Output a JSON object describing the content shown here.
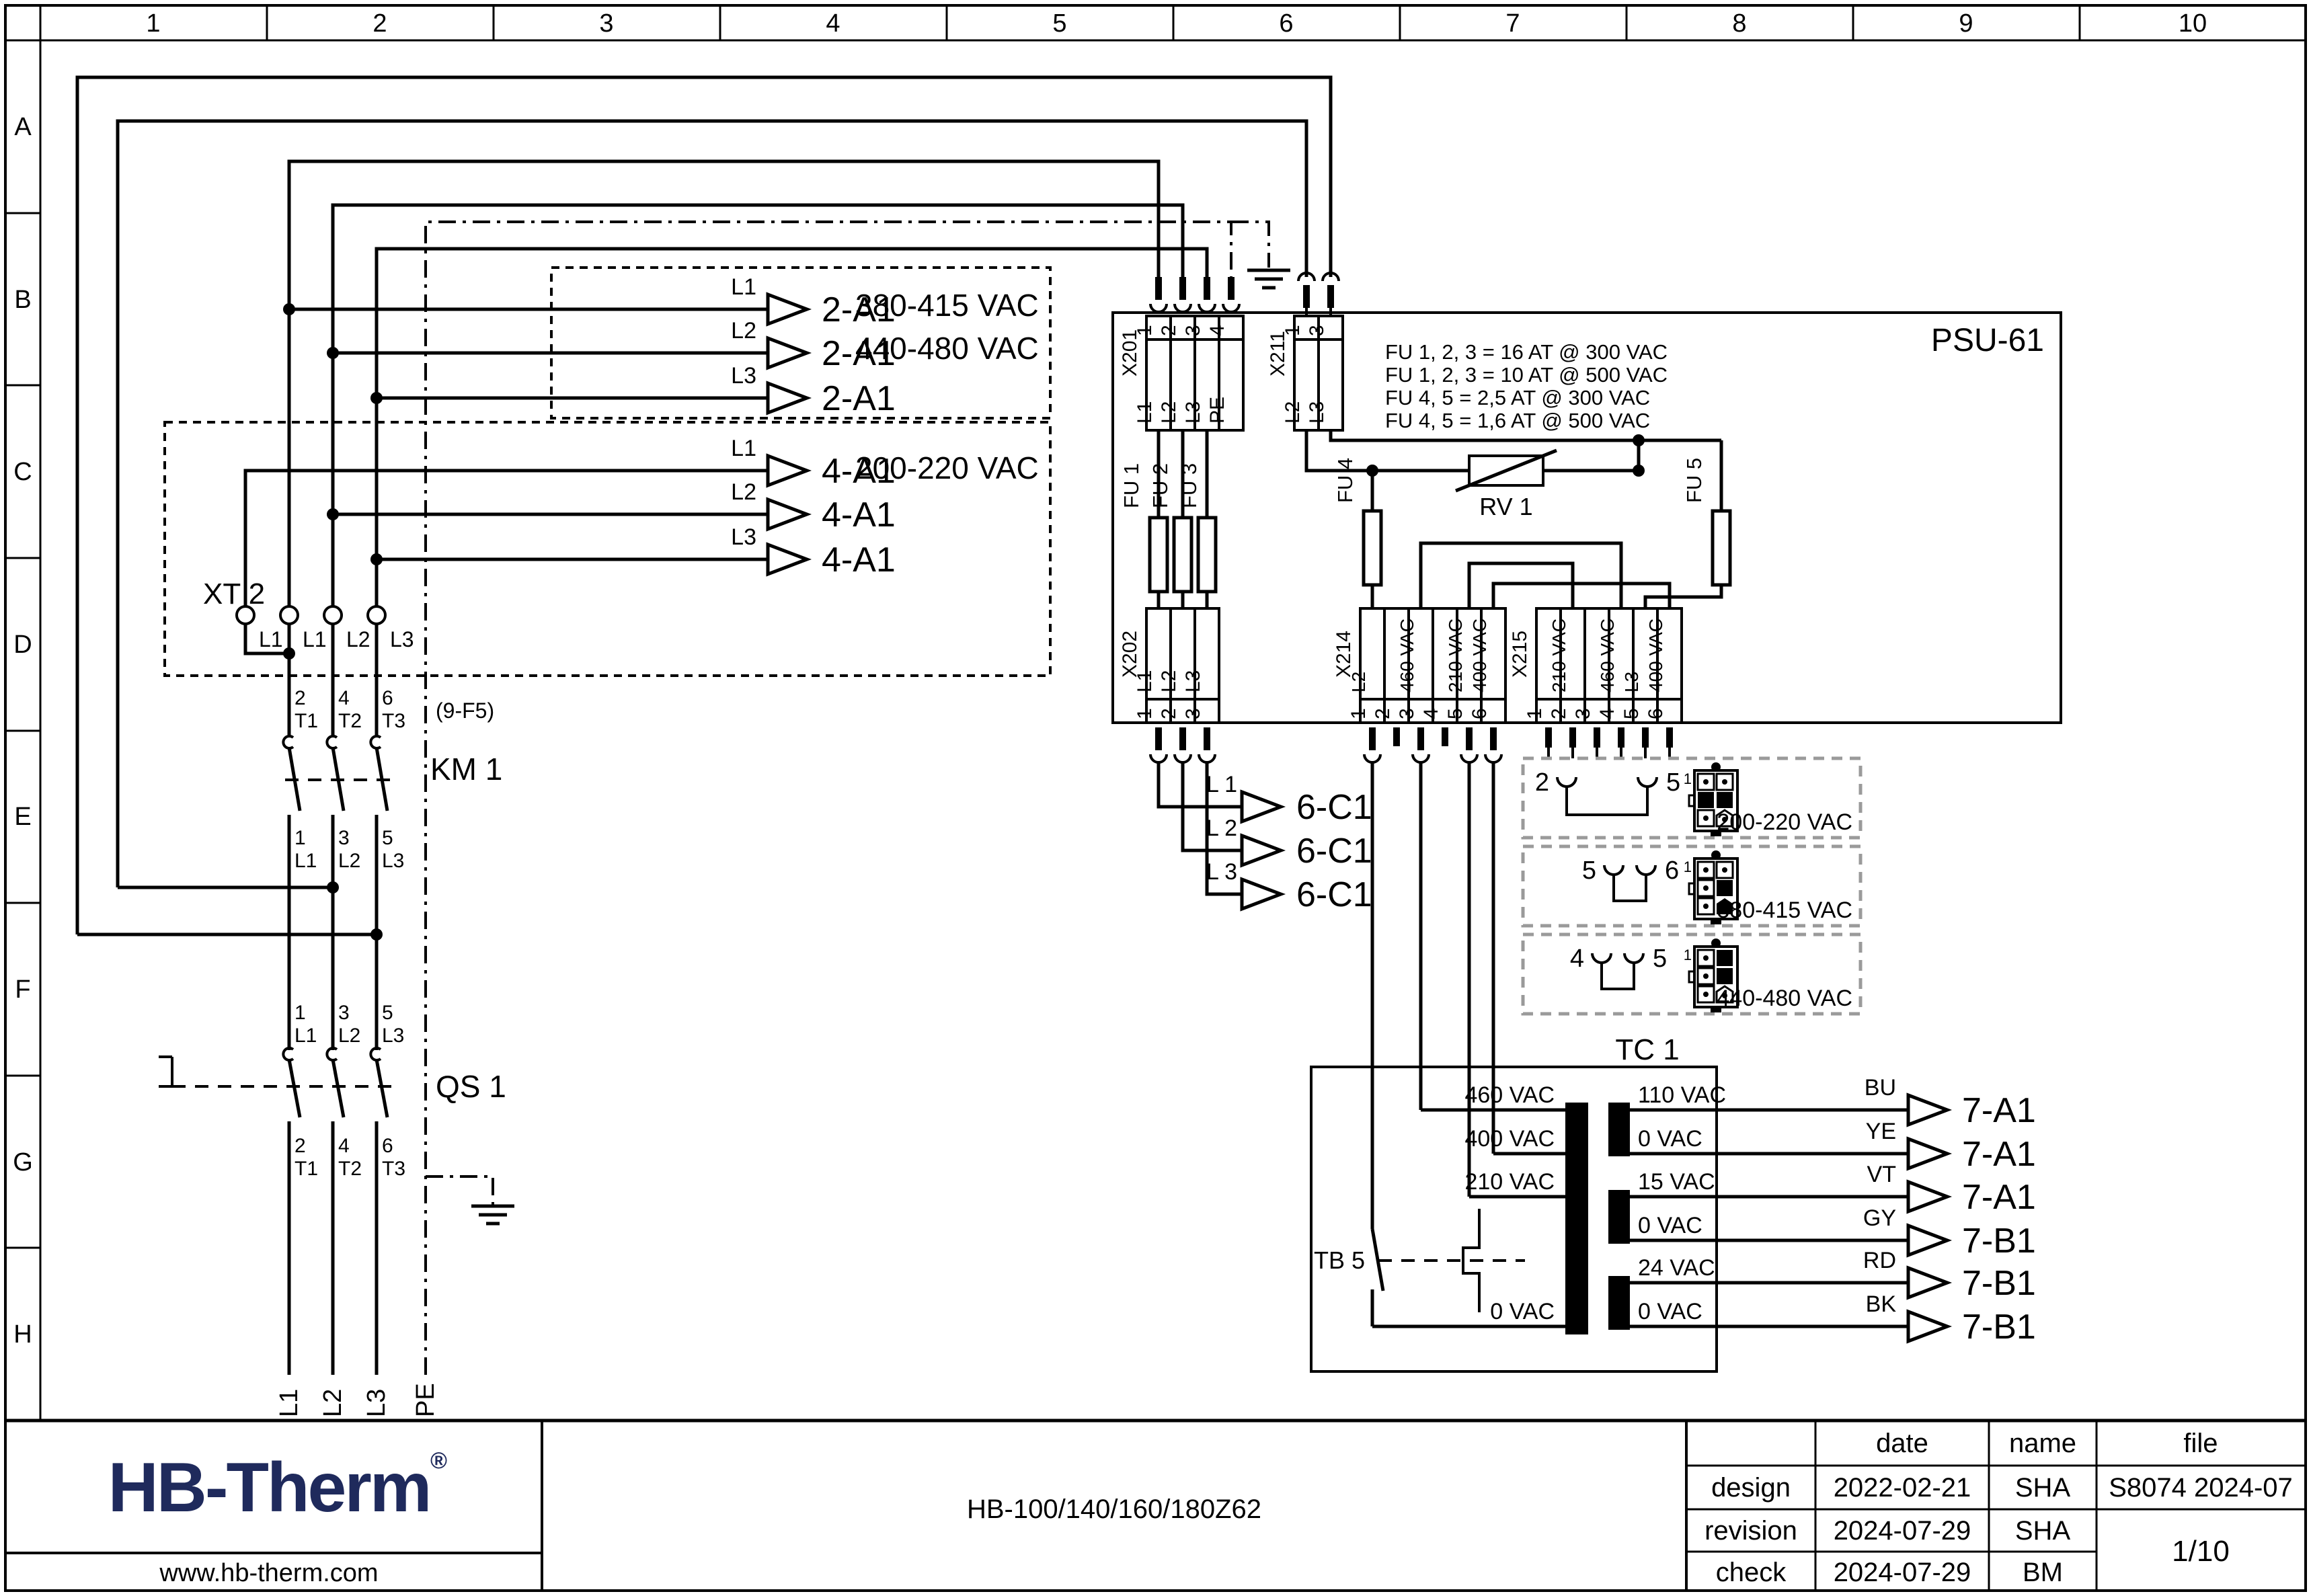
{
  "grid": {
    "cols": [
      "1",
      "2",
      "3",
      "4",
      "5",
      "6",
      "7",
      "8",
      "9",
      "10"
    ],
    "rows": [
      "A",
      "B",
      "C",
      "D",
      "E",
      "F",
      "G",
      "H"
    ]
  },
  "hv_box": {
    "wire_labels": [
      "L1",
      "L2",
      "L3"
    ],
    "targets": [
      "2-A1",
      "2-A1",
      "2-A1"
    ],
    "voltage1": "380-415 VAC",
    "voltage2": "440-480 VAC"
  },
  "lv_box": {
    "wire_labels": [
      "L1",
      "L2",
      "L3"
    ],
    "targets": [
      "4-A1",
      "4-A1",
      "4-A1"
    ],
    "voltage": "200-220 VAC",
    "xt2": "XT 2",
    "terminals": [
      "L1",
      "L1",
      "L2",
      "L3"
    ]
  },
  "km1": {
    "ref": "(9-F5)",
    "name": "KM 1",
    "top": [
      "2",
      "T1",
      "4",
      "T2",
      "6",
      "T3"
    ],
    "bottom": [
      "1",
      "L1",
      "3",
      "L2",
      "5",
      "L3"
    ]
  },
  "qs1": {
    "name": "QS 1",
    "top": [
      "1",
      "L1",
      "3",
      "L2",
      "5",
      "L3"
    ],
    "bottom": [
      "2",
      "T1",
      "4",
      "T2",
      "6",
      "T3"
    ]
  },
  "incoming": [
    "L1",
    "L2",
    "L3",
    "PE"
  ],
  "psu": {
    "name": "PSU-61",
    "fuse_notes": [
      "FU 1, 2, 3 = 16 AT @ 300 VAC",
      "FU 1, 2, 3 = 10 AT @ 500 VAC",
      "FU 4, 5 = 2,5 AT @ 300 VAC",
      "FU 4, 5 = 1,6 AT @ 500 VAC"
    ],
    "x201": {
      "name": "X201",
      "pins": [
        "1",
        "2",
        "3",
        "4"
      ],
      "labels": [
        "L1",
        "L2",
        "L3",
        "PE"
      ]
    },
    "x211": {
      "name": "X211",
      "pins": [
        "1",
        "3"
      ],
      "labels": [
        "L2",
        "L3"
      ]
    },
    "x202": {
      "name": "X202",
      "pins": [
        "1",
        "2",
        "3"
      ],
      "labels": [
        "L1",
        "L2",
        "L3"
      ]
    },
    "x214": {
      "name": "X214",
      "pins": [
        "1",
        "2",
        "3",
        "4",
        "5",
        "6"
      ],
      "labels": [
        "L2",
        "",
        "460 VAC",
        "",
        "210 VAC",
        "400 VAC"
      ]
    },
    "x215": {
      "name": "X215",
      "pins": [
        "1",
        "2",
        "3",
        "4",
        "5",
        "6"
      ],
      "labels": [
        "",
        "210 VAC",
        "",
        "460 VAC",
        "L3",
        "400 VAC"
      ]
    },
    "fu1": "FU 1",
    "fu2": "FU 2",
    "fu3": "FU 3",
    "fu4": "FU 4",
    "fu5": "FU 5",
    "rv1": "RV 1"
  },
  "c1": {
    "wire_labels": [
      "L 1",
      "L 2",
      "L 3"
    ],
    "targets": [
      "6-C1",
      "6-C1",
      "6-C1"
    ]
  },
  "selector": {
    "pin1": "1",
    "options": [
      {
        "a": "2",
        "b": "5",
        "voltage": "200-220 VAC"
      },
      {
        "a": "5",
        "b": "6",
        "voltage": "380-415 VAC"
      },
      {
        "a": "4",
        "b": "5",
        "voltage": "440-480 VAC"
      }
    ]
  },
  "tc1": {
    "name": "TC 1",
    "tb5": "TB 5",
    "primary": [
      "460 VAC",
      "400 VAC",
      "210 VAC",
      "0 VAC"
    ],
    "secondary": [
      "110 VAC",
      "0 VAC",
      "15 VAC",
      "0 VAC",
      "24 VAC",
      "0 VAC"
    ]
  },
  "outputs": {
    "colors": [
      "BU",
      "YE",
      "VT",
      "GY",
      "RD",
      "BK"
    ],
    "targets": [
      "7-A1",
      "7-A1",
      "7-A1",
      "7-B1",
      "7-B1",
      "7-B1"
    ]
  },
  "titleblock": {
    "logo": "HB-Therm",
    "reg": "®",
    "website": "www.hb-therm.com",
    "model": "HB-100/140/160/180Z62",
    "col_date": "date",
    "col_name": "name",
    "col_file": "file",
    "rows": [
      {
        "label": "design",
        "date": "2022-02-21",
        "name": "SHA"
      },
      {
        "label": "revision",
        "date": "2024-07-29",
        "name": "SHA"
      },
      {
        "label": "check",
        "date": "2024-07-29",
        "name": "BM"
      }
    ],
    "file_value": "S8074 2024-07",
    "page": "1/10"
  },
  "colors": {
    "ink": "#000000",
    "logo": "#1f2a5c",
    "selector_dash": "#9a9a9a"
  }
}
